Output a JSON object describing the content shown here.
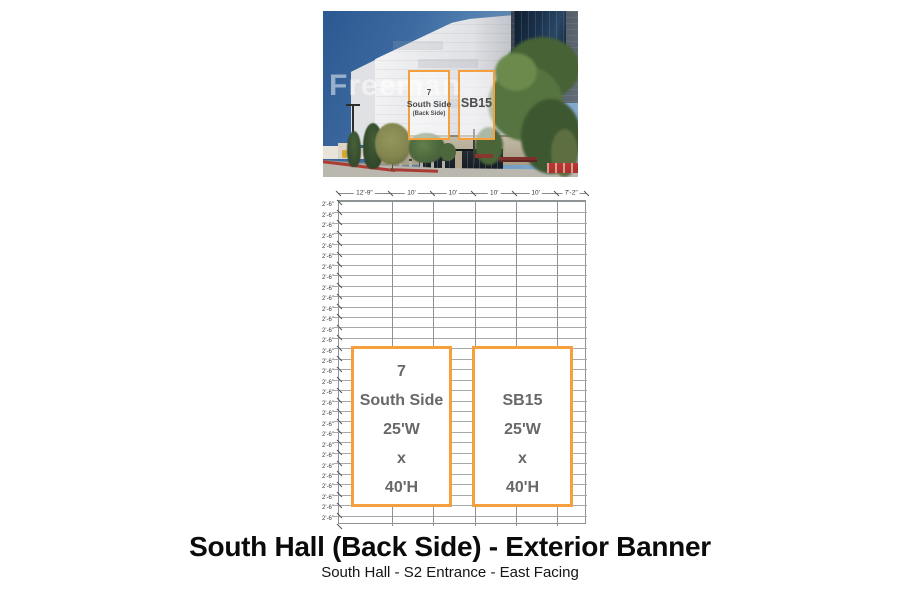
{
  "photo": {
    "watermark": "Freeman",
    "banner_left": {
      "line1": "7",
      "line2": "South Side",
      "line3": "(Back Side)"
    },
    "banner_right": {
      "label": "SB15"
    }
  },
  "diagram": {
    "accent_color": "#F5A03C",
    "col_labels": [
      "12'-9\"",
      "10'",
      "10'",
      "10'",
      "10'",
      "7'-2\""
    ],
    "col_widths_ft": [
      12.75,
      10,
      10,
      10,
      10,
      7.1667
    ],
    "row_label": "2'-6\"",
    "row_count": 31,
    "row_height_ft": 2.5,
    "banners": [
      {
        "id": "7-south-side",
        "lines": [
          "7",
          "South Side",
          "25'W",
          "x",
          "40'H"
        ]
      },
      {
        "id": "sb15",
        "lines": [
          "SB15",
          "25'W",
          "x",
          "40'H"
        ]
      }
    ]
  },
  "footer": {
    "title": "South Hall (Back Side) - Exterior Banner",
    "subtitle": "South Hall - S2 Entrance - East Facing"
  }
}
